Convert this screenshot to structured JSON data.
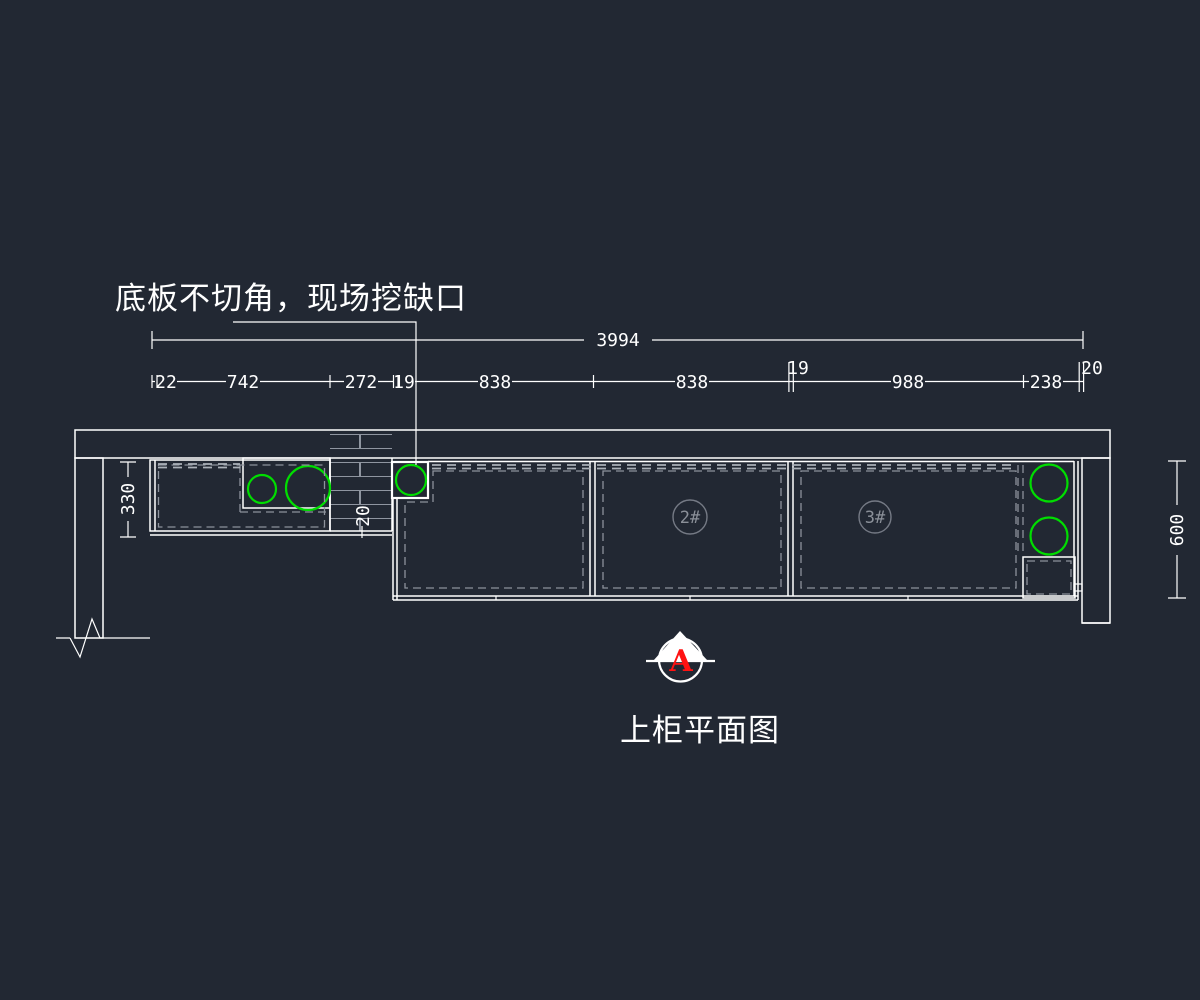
{
  "drawing": {
    "note": "底板不切角，现场挖缺口",
    "title": "上柜平面图",
    "marker_letter": "A"
  },
  "dimensions": {
    "overall": "3994",
    "segments": [
      "22",
      "742",
      "272",
      "19",
      "838",
      "838",
      "19",
      "988",
      "238",
      "20"
    ],
    "left_depth": "330",
    "right_depth": "600",
    "pier_offset": "20"
  },
  "labels": {
    "cab2": "2#",
    "cab3": "3#"
  },
  "colors": {
    "background": "#222833",
    "line": "#ffffff",
    "hatch": "#8f95a0",
    "dashed": "#8d929c",
    "green": "#00dd00",
    "red": "#ff1212",
    "label_gray": "#757a85"
  }
}
